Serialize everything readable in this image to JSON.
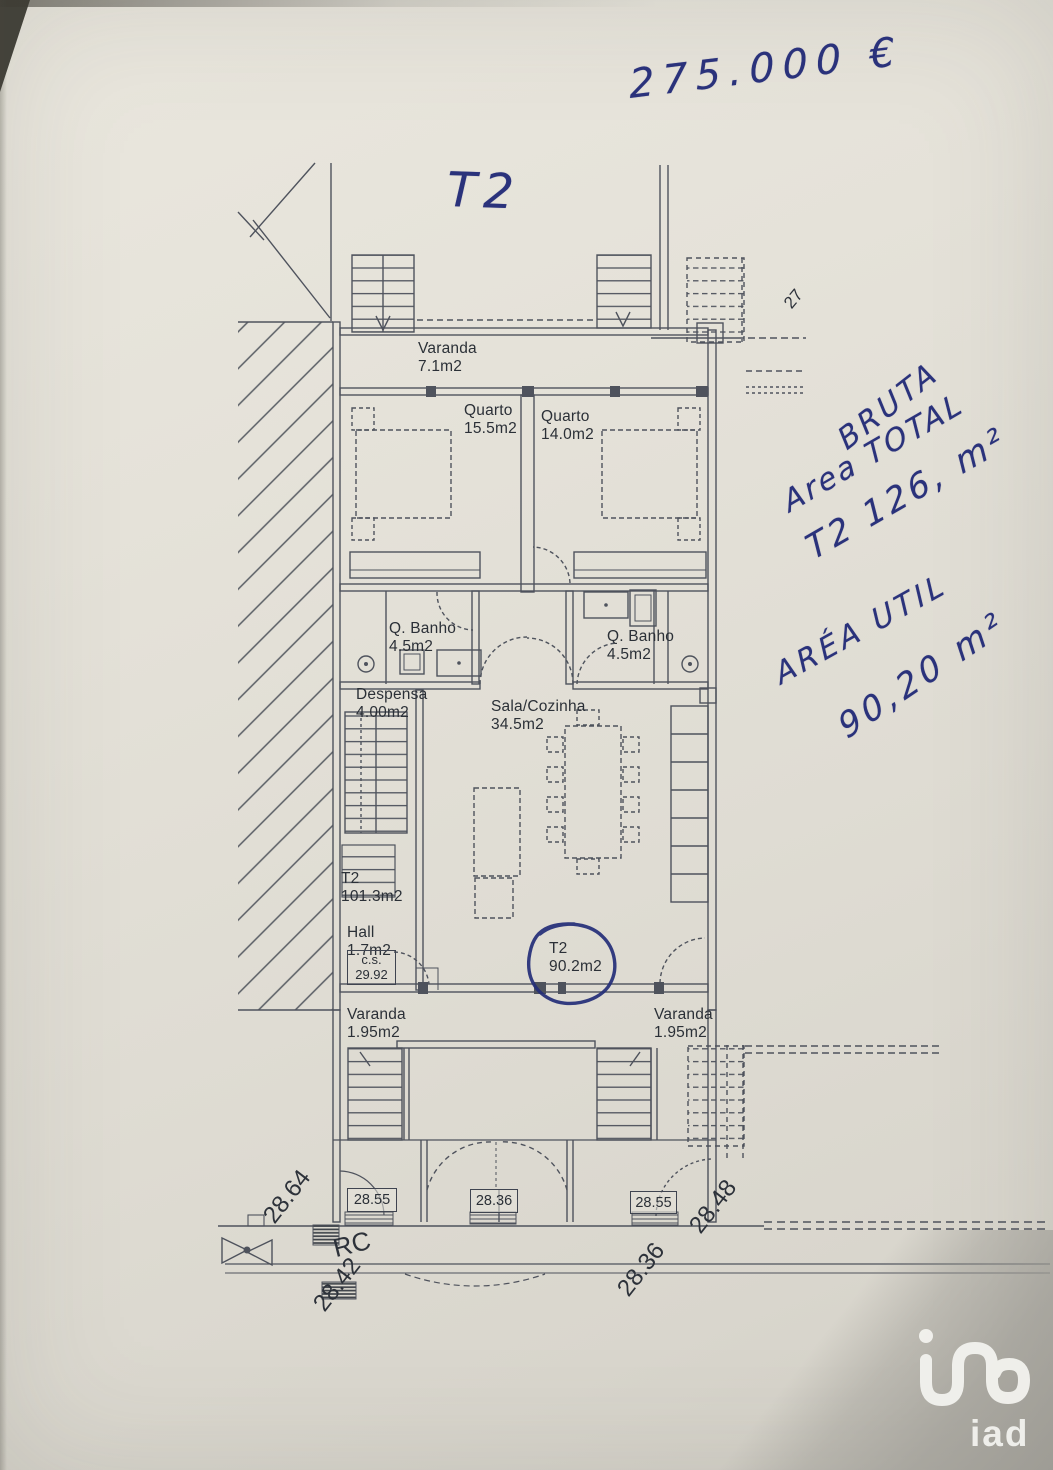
{
  "handwritten": {
    "price": "275.000 €",
    "unit_label": "T2",
    "bruta_line1": "BRUTA",
    "bruta_line2": "Area TOTAL",
    "bruta_line3": "T2 126, m²",
    "util_line1": "ARÉA UTIL",
    "util_line2": "90,20 m²"
  },
  "plan": {
    "rooms": {
      "varanda_top": {
        "name": "Varanda",
        "area": "7.1m2"
      },
      "quarto_left": {
        "name": "Quarto",
        "area": "15.5m2"
      },
      "quarto_right": {
        "name": "Quarto",
        "area": "14.0m2"
      },
      "banho_left": {
        "name": "Q. Banho",
        "area": "4.5m2"
      },
      "banho_right": {
        "name": "Q. Banho",
        "area": "4.5m2"
      },
      "despensa": {
        "name": "Despensa",
        "area": "4.00m2"
      },
      "sala": {
        "name": "Sala/Cozinha",
        "area": "34.5m2"
      },
      "t2_total": {
        "name": "T2",
        "area": "101.3m2"
      },
      "hall": {
        "name": "Hall",
        "area": "1.7m2"
      },
      "cs": {
        "name": "c.s.",
        "value": "29.92"
      },
      "t2_util": {
        "name": "T2",
        "area": "90.2m2"
      },
      "varanda_bottom_left": {
        "name": "Varanda",
        "area": "1.95m2"
      },
      "varanda_bottom_right": {
        "name": "Varanda",
        "area": "1.95m2"
      }
    },
    "levels": {
      "box_left": "28.55",
      "box_center": "28.36",
      "box_right": "28.55",
      "street_left": "28.64",
      "rc": "RC",
      "rc_level": "28.42",
      "street_right_low": "28.36",
      "street_right_high": "28.48",
      "lot_number": "27"
    }
  },
  "watermark": {
    "logo": "iad"
  }
}
